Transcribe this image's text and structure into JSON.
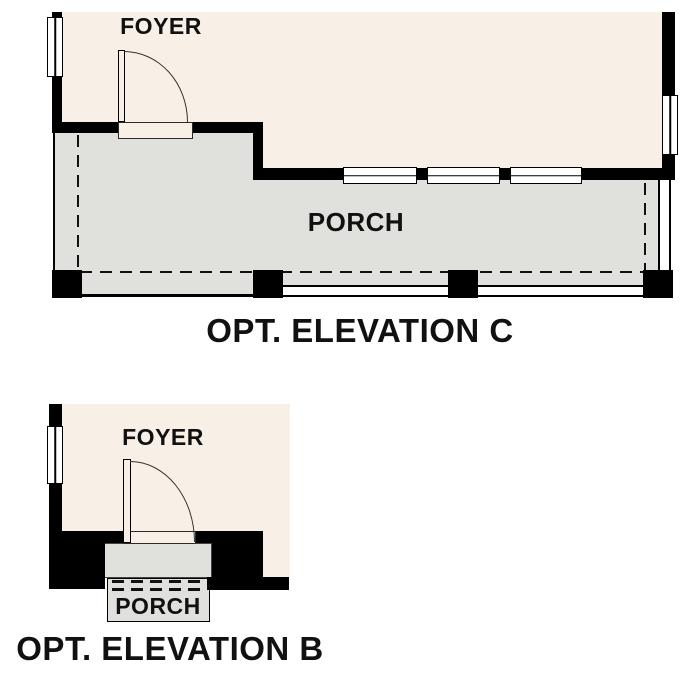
{
  "plans": {
    "c": {
      "foyer_label": "FOYER",
      "porch_label": "PORCH",
      "caption": "OPT. ELEVATION C"
    },
    "b": {
      "foyer_label": "FOYER",
      "porch_label": "PORCH",
      "caption": "OPT. ELEVATION B"
    }
  },
  "colors": {
    "floor_beige": "#f8f0e6",
    "porch_gray": "#e0e0dd",
    "wall_black": "#000000",
    "line_dark": "#111111",
    "text": "#111111",
    "background": "#ffffff"
  }
}
